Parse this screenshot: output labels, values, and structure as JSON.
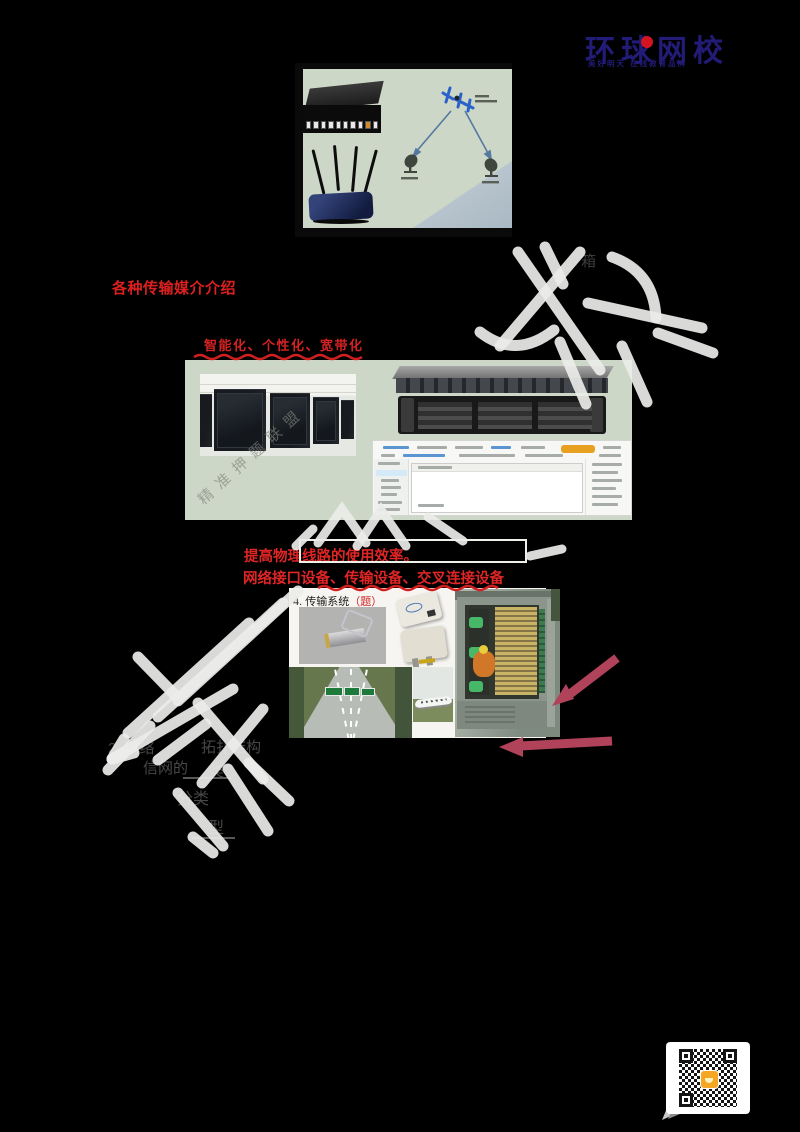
{
  "logo": {
    "text": "环球网校",
    "tagline": "美好明天 在线教育品牌",
    "color": "#221c78",
    "dot_color": "#d41420"
  },
  "texts": {
    "media_heading": "各种传输媒介介绍",
    "trend_line": "智能化、个性化、宽带化",
    "efficiency_line": "提高物理线路的使用效率。",
    "devices_line": "网络接口设备、传输设备、交叉连接设备",
    "section_title": "4. 传输系统",
    "section_suffix": "（题）",
    "annotation_char": "箱"
  },
  "notes": {
    "frag_topic": "2. 网络",
    "frag_topology": "拓扑结构",
    "frag_network": "信网的",
    "frag_class": "类",
    "frag_fenlei": "分类",
    "frag_xing": "型"
  },
  "watermark": {
    "text": "精准押题联盟"
  },
  "colors": {
    "page_bg": "#000000",
    "slide_bg": "#cdd7c7",
    "accent_red": "#dc2020",
    "annotation_arrow": "#b0425a",
    "scribble": "#ecede9"
  }
}
